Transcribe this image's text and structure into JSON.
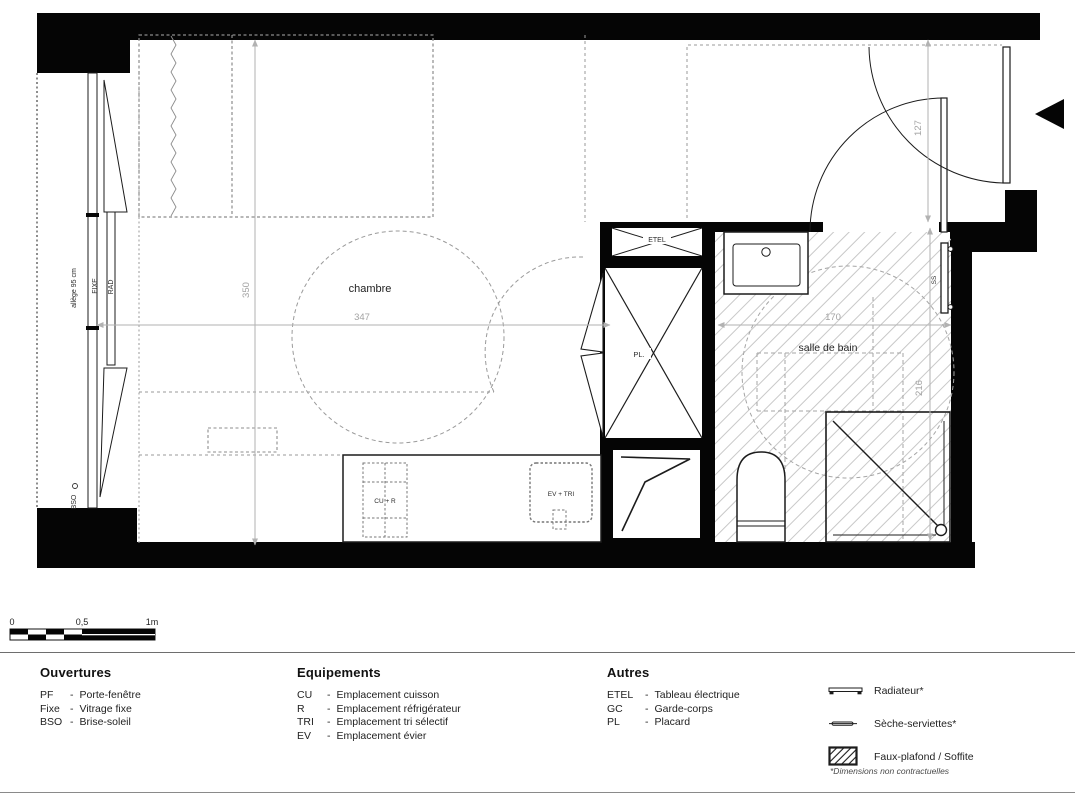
{
  "colors": {
    "wall": "#050505",
    "line": "#1c1c1c",
    "dashed": "#9a9a9a",
    "hatch": "#c8c8c8",
    "dimension": "#b2b2b2",
    "dimension_text": "#a3a3a3",
    "background": "#ffffff"
  },
  "plan": {
    "rooms": {
      "chambre": "chambre",
      "salle_de_bain": "salle de bain"
    },
    "labels": {
      "etel": "ETEL",
      "pl": "PL.",
      "cu_r": "CU + R",
      "ev_tri": "EV + TRI",
      "ss": "SS",
      "allege": "allège 95 cm",
      "fixe": "FIXE",
      "rad": "RAD",
      "bso": "BSO"
    },
    "dimensions": {
      "chambre_width": "347",
      "chambre_depth": "350",
      "sdb_width": "170",
      "sdb_depth": "216",
      "entry_depth": "127"
    }
  },
  "scale_bar": {
    "tick_0": "0",
    "tick_05": "0,5",
    "tick_1": "1m"
  },
  "legend": {
    "ouvertures": {
      "title": "Ouvertures",
      "items": [
        {
          "abbr": "PF",
          "dash": "-",
          "label": "Porte-fenêtre"
        },
        {
          "abbr": "Fixe",
          "dash": "-",
          "label": "Vitrage fixe"
        },
        {
          "abbr": "BSO",
          "dash": "-",
          "label": "Brise-soleil"
        }
      ]
    },
    "equipements": {
      "title": "Equipements",
      "items": [
        {
          "abbr": "CU",
          "dash": "-",
          "label": "Emplacement cuisson"
        },
        {
          "abbr": "R",
          "dash": "-",
          "label": "Emplacement réfrigérateur"
        },
        {
          "abbr": "TRI",
          "dash": "-",
          "label": "Emplacement tri sélectif"
        },
        {
          "abbr": "EV",
          "dash": "-",
          "label": "Emplacement évier"
        }
      ]
    },
    "autres": {
      "title": "Autres",
      "items": [
        {
          "abbr": "ETEL",
          "dash": "-",
          "label": "Tableau électrique"
        },
        {
          "abbr": "GC",
          "dash": "-",
          "label": "Garde-corps"
        },
        {
          "abbr": "PL",
          "dash": "-",
          "label": "Placard"
        }
      ]
    },
    "symbols": [
      {
        "icon": "radiator-icon",
        "label": "Radiateur*"
      },
      {
        "icon": "towel-dryer-icon",
        "label": "Sèche-serviettes*"
      },
      {
        "icon": "false-ceiling-icon",
        "label": "Faux-plafond / Soffite"
      }
    ],
    "footnote": "*Dimensions non contractuelles"
  }
}
